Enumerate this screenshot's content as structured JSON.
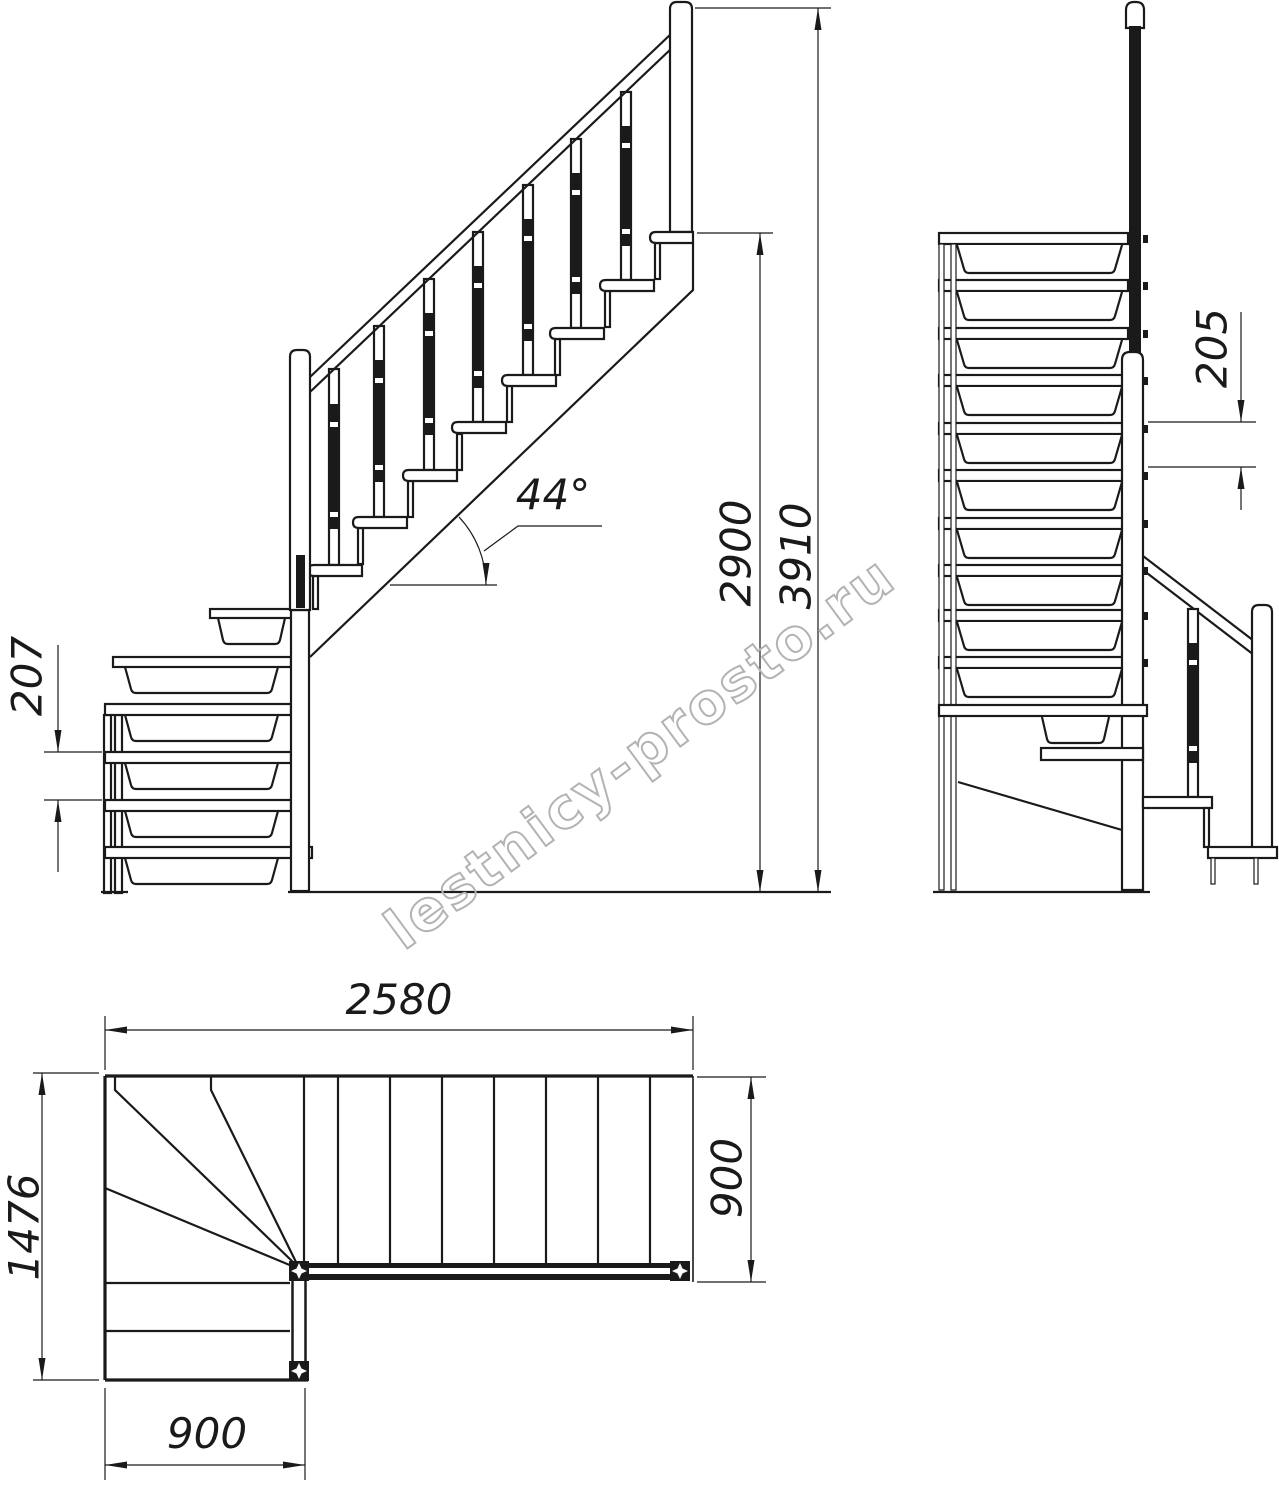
{
  "side_view": {
    "step_rise": "207",
    "angle": "44°",
    "floor_height": "2900",
    "total_height": "3910"
  },
  "front_view": {
    "step_rise": "205"
  },
  "plan_view": {
    "total_run": "2580",
    "total_depth": "1476",
    "flight_width": "900",
    "lower_flight_width": "900"
  },
  "watermark": {
    "text": "lestnicy-prosto.ru"
  },
  "colors": {
    "line": "#1a1a1a",
    "watermark": "#b3b3b3",
    "paper": "#ffffff"
  }
}
